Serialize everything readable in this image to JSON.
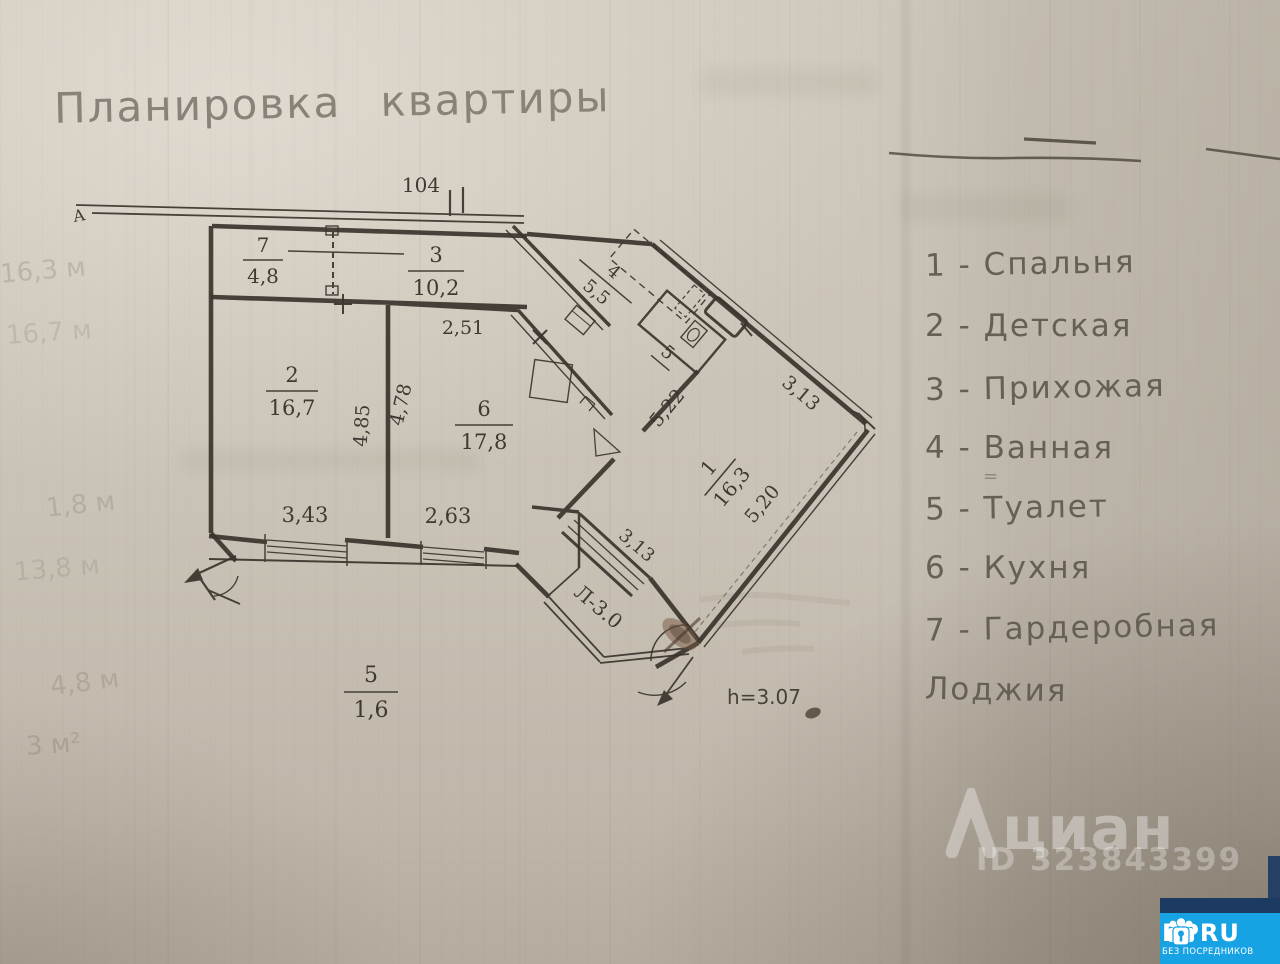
{
  "title": "Планировка квартиры",
  "plan": {
    "unit_number": "104",
    "corner_mark": "А",
    "ceiling_height": "h=3.07",
    "rooms": {
      "r7": {
        "num": "7",
        "area": "4,8"
      },
      "r3": {
        "num": "3",
        "area": "10,2"
      },
      "r2": {
        "num": "2",
        "area": "16,7"
      },
      "r6": {
        "num": "6",
        "area": "17,8"
      },
      "r4": {
        "num": "4",
        "area": "5,5"
      },
      "r5": {
        "num": "5"
      },
      "r1": {
        "num": "1",
        "area": "16,3"
      },
      "r5_note": {
        "num": "5",
        "area": "1,6"
      },
      "loggia": {
        "label": "Л-3.0"
      }
    },
    "dims": {
      "kitchen_top": "2,51",
      "room2_side": "4,85",
      "kitchen_side": "4,78",
      "room2_window": "3,43",
      "kitchen_window": "2,63",
      "bedroom_upper_left": "5,22",
      "bedroom_upper_right": "3,13",
      "bedroom_lower_right": "5,20",
      "loggia_window": "3,13"
    }
  },
  "legend": {
    "items": [
      {
        "text": "1 - Спальня"
      },
      {
        "text": "2 - Детская"
      },
      {
        "text": "3 - Прихожая"
      },
      {
        "text": "4 - Ванная"
      },
      {
        "text": "5 - Туалет"
      },
      {
        "text": "6 - Кухня"
      },
      {
        "text": "7 - Гардеробная"
      },
      {
        "text": "Лоджия"
      }
    ],
    "stray_mark": "="
  },
  "ghost_notes": [
    {
      "text": "16,3 м"
    },
    {
      "text": "16,7 м"
    },
    {
      "text": "1,8 м"
    },
    {
      "text": "13,8 м"
    },
    {
      "text": "4,8 м"
    },
    {
      "text": "3 м²"
    }
  ],
  "watermark": {
    "brand": "циан",
    "listing_id": "ID 323843399"
  },
  "badge": {
    "brand": "BPRU",
    "tagline": "БЕЗ ПОСРЕДНИКОВ"
  },
  "colors": {
    "paper": "#c9c2b6",
    "ink": "#3a342d",
    "pencil": "#6a635a",
    "badge_blue": "#17a2e3",
    "badge_navy": "#1d3a63",
    "watermark_white": "#ffffff"
  }
}
